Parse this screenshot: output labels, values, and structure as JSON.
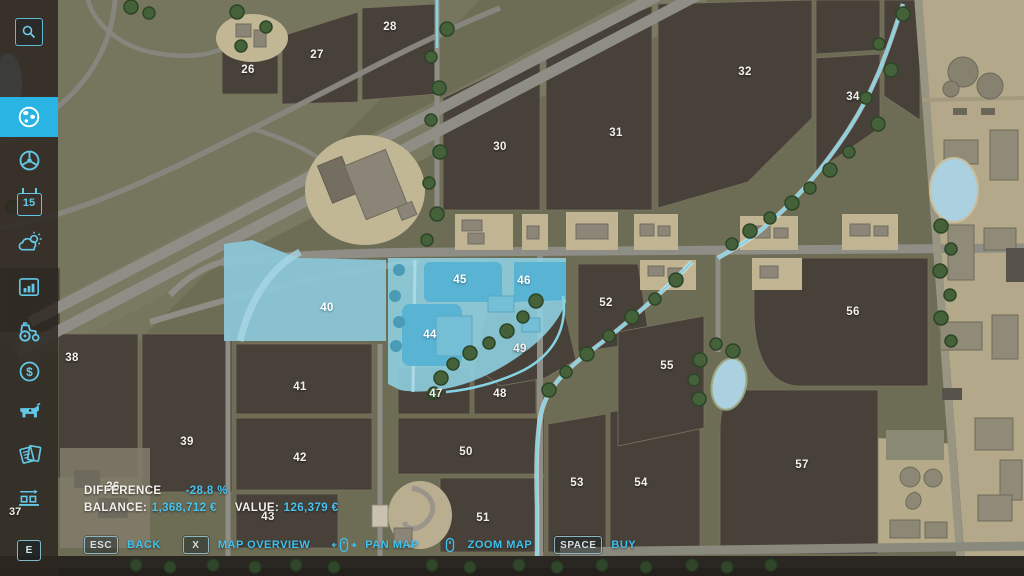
{
  "title": "Farm map overview - buy land",
  "colors": {
    "accent": "#29b4e4",
    "highlight_area": "#8fd2e3",
    "highlight_field": "#55b1d3",
    "field": "#48413a",
    "map_background": "#6d6c55",
    "value_text": "#45c4f2"
  },
  "sidebar": {
    "items": [
      {
        "id": "search",
        "icon": "magnifier-icon"
      },
      {
        "id": "map",
        "icon": "globe-icon",
        "active": true
      },
      {
        "id": "vehicles",
        "icon": "steering-wheel-icon"
      },
      {
        "id": "calendar",
        "icon": "calendar-icon",
        "text": "15"
      },
      {
        "id": "weather",
        "icon": "weather-icon"
      },
      {
        "id": "statistics",
        "icon": "bar-chart-icon"
      },
      {
        "id": "garage",
        "icon": "tractor-icon"
      },
      {
        "id": "finances",
        "icon": "dollar-icon",
        "glyph": "$"
      },
      {
        "id": "animals",
        "icon": "cow-icon"
      },
      {
        "id": "contracts",
        "icon": "documents-icon"
      },
      {
        "id": "production",
        "icon": "production-chain-icon",
        "count": "37"
      },
      {
        "id": "interact",
        "icon": "key-icon",
        "key": "E"
      }
    ]
  },
  "hud": {
    "difference_label": "DIFFERENCE",
    "difference_value": "-28.8 %",
    "balance_label": "BALANCE:",
    "balance_value": "1,368,712 €",
    "value_label": "VALUE:",
    "value_value": "126,379 €"
  },
  "bottom_bar": {
    "items": [
      {
        "key": "ESC",
        "label": "BACK"
      },
      {
        "key": "X",
        "label": "MAP OVERVIEW"
      },
      {
        "icon": "mouse-pan-icon",
        "label": "PAN MAP"
      },
      {
        "icon": "mouse-zoom-icon",
        "label": "ZOOM MAP"
      },
      {
        "key": "SPACE",
        "label": "BUY"
      }
    ]
  },
  "map": {
    "highlighted_fields": [
      40,
      44,
      45,
      46
    ],
    "fields": [
      {
        "n": 26,
        "x": 248,
        "y": 70
      },
      {
        "n": 27,
        "x": 317,
        "y": 55
      },
      {
        "n": 28,
        "x": 390,
        "y": 27
      },
      {
        "n": 30,
        "x": 500,
        "y": 147
      },
      {
        "n": 31,
        "x": 616,
        "y": 133
      },
      {
        "n": 32,
        "x": 745,
        "y": 72
      },
      {
        "n": 34,
        "x": 853,
        "y": 97
      },
      {
        "n": 36,
        "x": 113,
        "y": 487
      },
      {
        "n": 38,
        "x": 72,
        "y": 358
      },
      {
        "n": 39,
        "x": 187,
        "y": 442
      },
      {
        "n": 40,
        "x": 327,
        "y": 308,
        "highlighted": true
      },
      {
        "n": 41,
        "x": 300,
        "y": 387
      },
      {
        "n": 42,
        "x": 300,
        "y": 458
      },
      {
        "n": 43,
        "x": 268,
        "y": 517
      },
      {
        "n": 44,
        "x": 430,
        "y": 335,
        "highlighted": true
      },
      {
        "n": 45,
        "x": 460,
        "y": 280,
        "highlighted": true
      },
      {
        "n": 46,
        "x": 524,
        "y": 281,
        "highlighted": true
      },
      {
        "n": 47,
        "x": 436,
        "y": 394
      },
      {
        "n": 48,
        "x": 500,
        "y": 394
      },
      {
        "n": 49,
        "x": 520,
        "y": 349
      },
      {
        "n": 50,
        "x": 466,
        "y": 452
      },
      {
        "n": 51,
        "x": 483,
        "y": 518
      },
      {
        "n": 52,
        "x": 606,
        "y": 303
      },
      {
        "n": 53,
        "x": 577,
        "y": 483
      },
      {
        "n": 54,
        "x": 641,
        "y": 483
      },
      {
        "n": 55,
        "x": 667,
        "y": 366
      },
      {
        "n": 56,
        "x": 853,
        "y": 312
      },
      {
        "n": 57,
        "x": 802,
        "y": 465
      }
    ]
  }
}
